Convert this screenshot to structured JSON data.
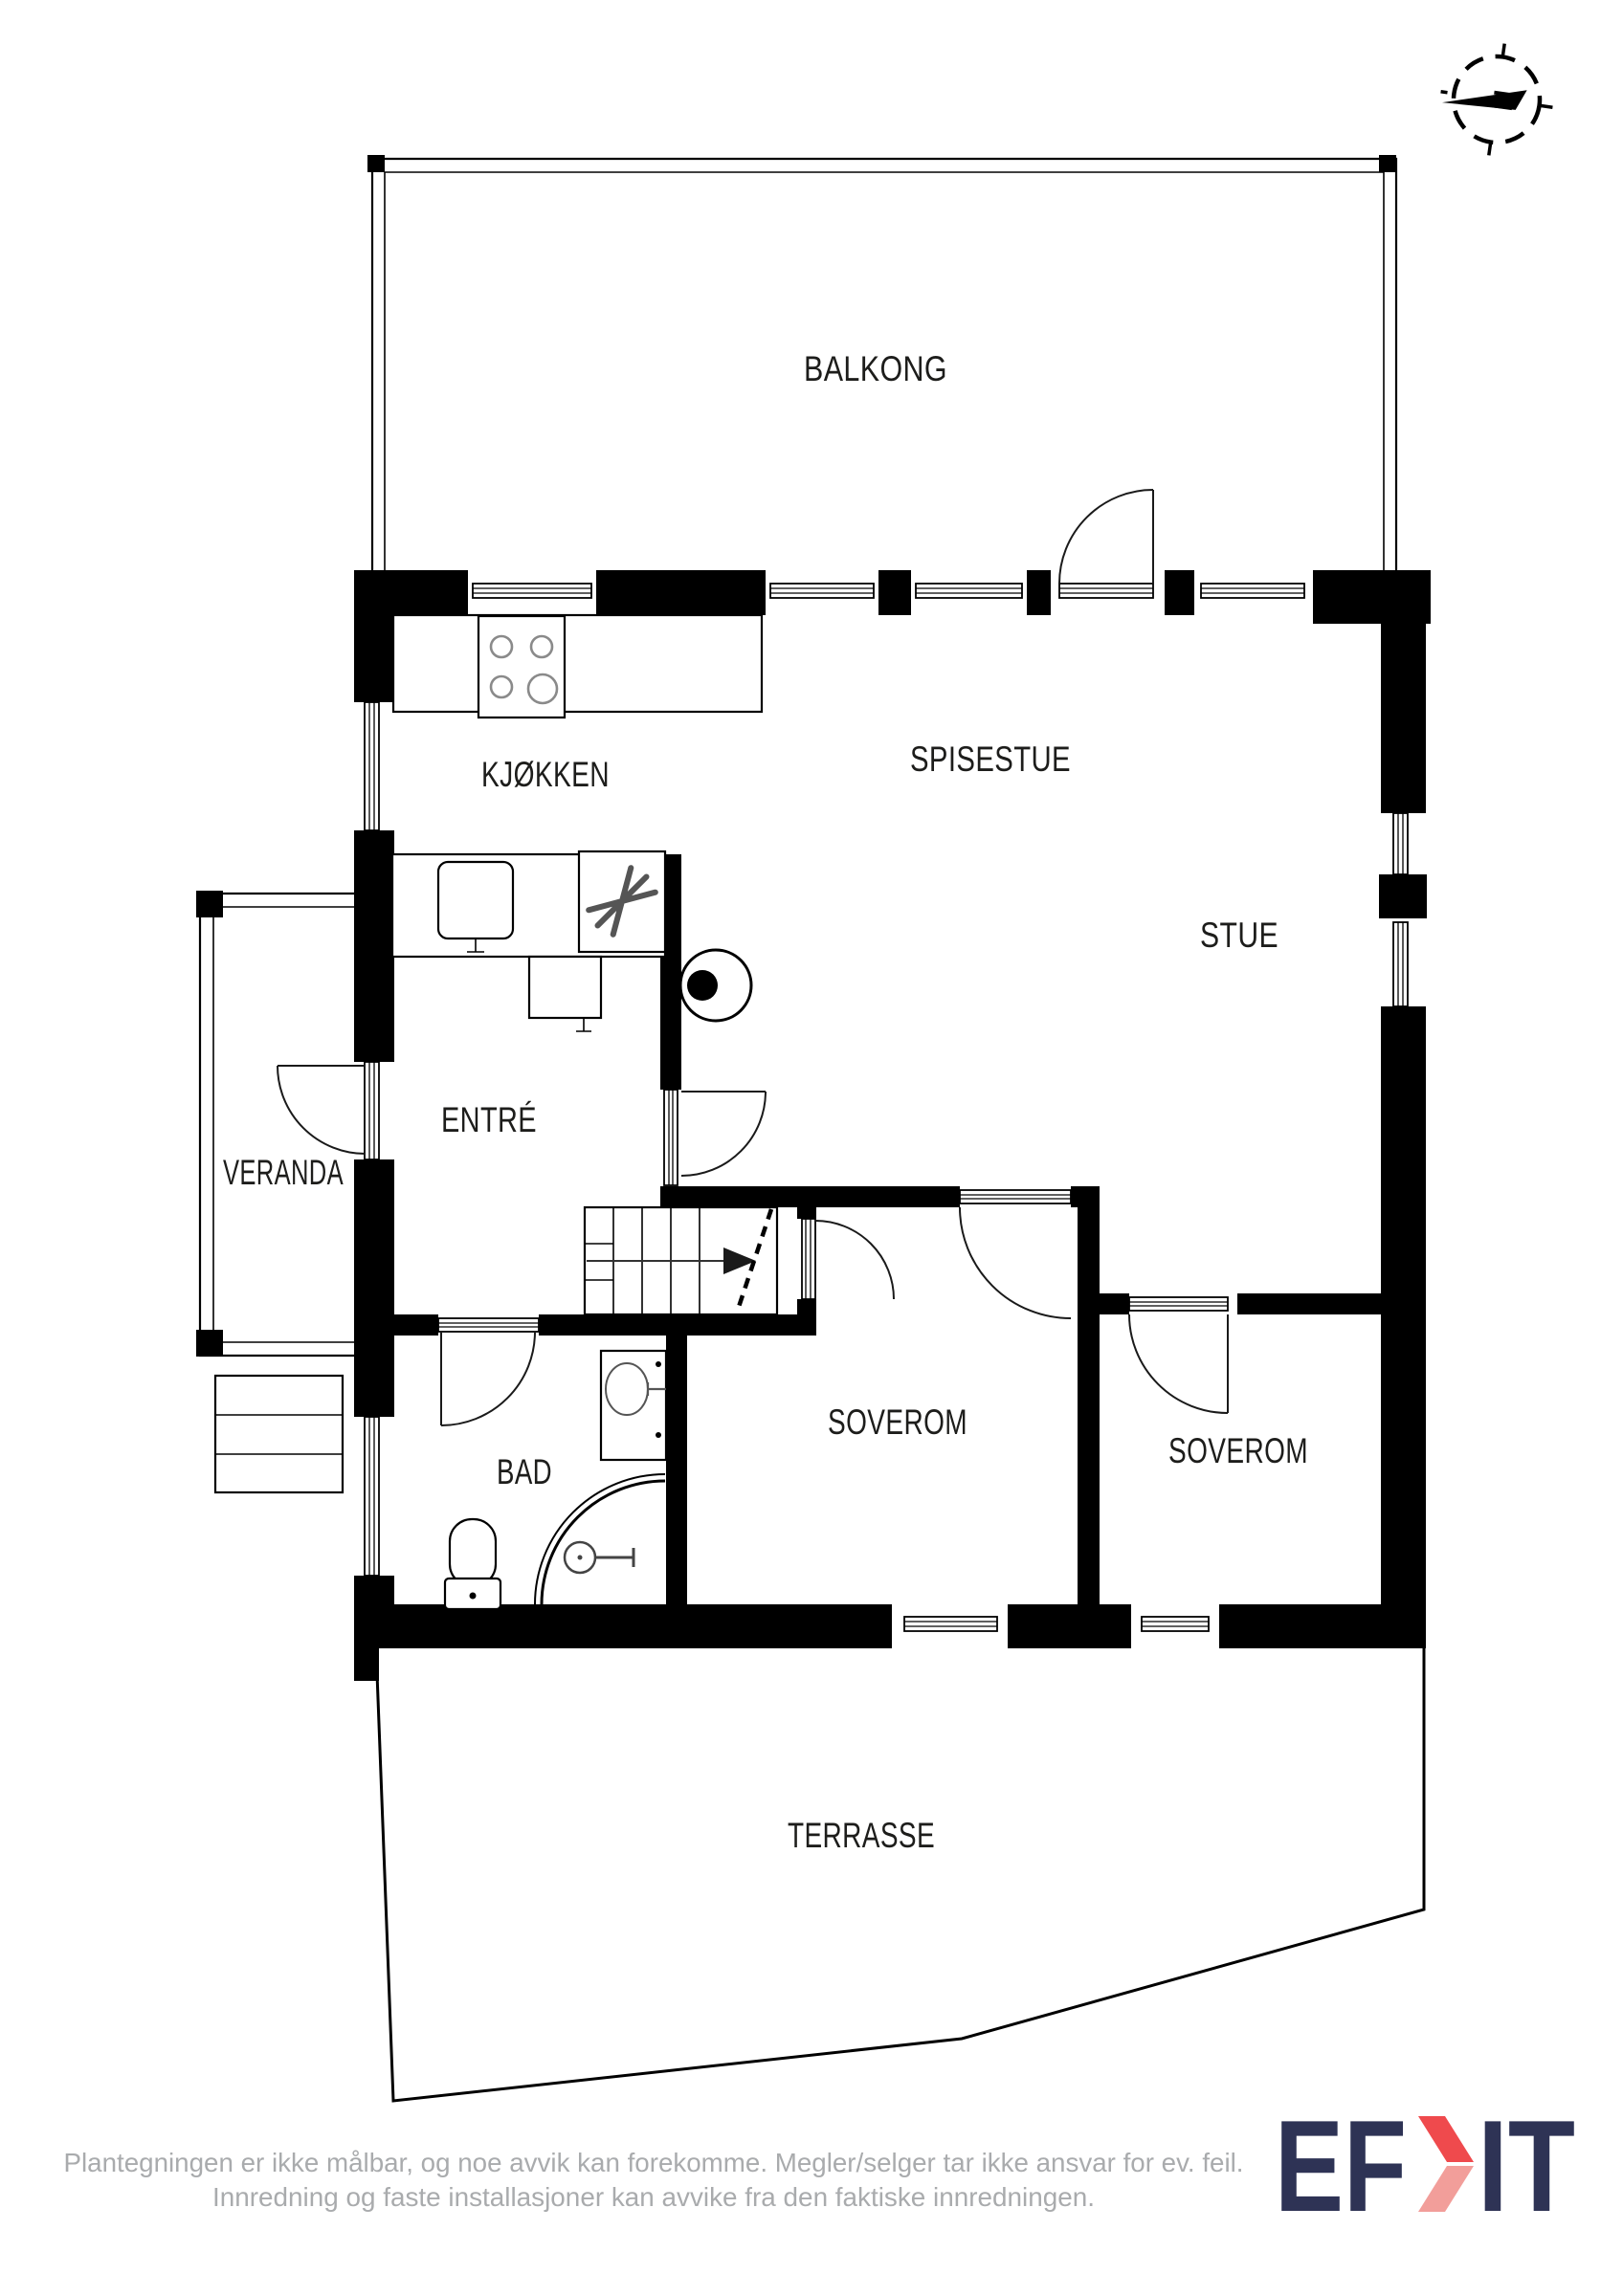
{
  "compass": {
    "north_label": "N"
  },
  "rooms": [
    {
      "id": "balkong",
      "label": "BALKONG"
    },
    {
      "id": "kjokken",
      "label": "KJØKKEN"
    },
    {
      "id": "spisestue",
      "label": "SPISESTUE"
    },
    {
      "id": "stue",
      "label": "STUE"
    },
    {
      "id": "entre",
      "label": "ENTRÉ"
    },
    {
      "id": "veranda",
      "label": "VERANDA"
    },
    {
      "id": "bad",
      "label": "BAD"
    },
    {
      "id": "soverom-1",
      "label": "SOVEROM"
    },
    {
      "id": "soverom-2",
      "label": "SOVEROM"
    },
    {
      "id": "terrasse",
      "label": "TERRASSE"
    }
  ],
  "footer": {
    "disclaimer_line1": "Plantegningen er ikke målbar, og noe avvik kan forekomme. Megler/selger tar ikke ansvar for ev. feil.",
    "disclaimer_line2": "Innredning og faste installasjoner kan avvike fra den faktiske innredningen."
  },
  "logo": {
    "name": "EFKT",
    "part1": "EF",
    "part2": "IT"
  },
  "colors": {
    "walls": "#000000",
    "room_label": "#1d1d1b",
    "disclaimer_text": "#a9abad",
    "logo_navy": "#2e3355",
    "logo_red": "#ef4a4d",
    "logo_red_light": "#f29e9a"
  }
}
